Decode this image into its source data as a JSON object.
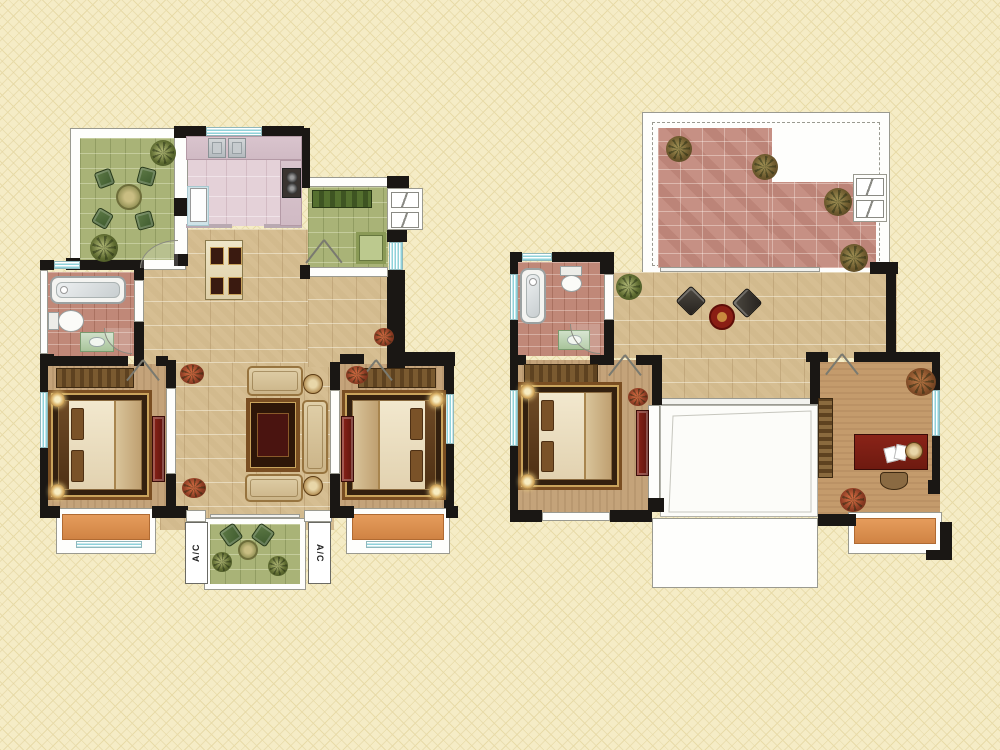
{
  "labels": {
    "ac_unit": "A/C"
  },
  "colors": {
    "background": "#F5ECC6",
    "lattice_line": "#E8DBA8",
    "wall_black": "#1A1714",
    "outline_gray": "#9A9A90",
    "floor_tan": "#D6BE92",
    "floor_tan_dark": "#C4A37A",
    "floor_study": "#C49B6C",
    "floor_kitchen_pink": "#E4D1D8",
    "counter_pink": "#D9C4CD",
    "floor_bath_red": "#C08878",
    "floor_brick_terrace": "#C69084",
    "floor_garden_green": "#A9B377",
    "bay_orange": "#DC9050",
    "window_teal": "#8FD2DA",
    "furniture_red": "#7E231B",
    "rug_dark": "#33200F",
    "rug_border": "#7A4E22",
    "sofa_beige": "#D8C49C",
    "lamp_glow": "#F2E0A8",
    "bench_green": "#49632C",
    "chair_green": "#3E5A2E",
    "wood_brown": "#6E4A26"
  }
}
